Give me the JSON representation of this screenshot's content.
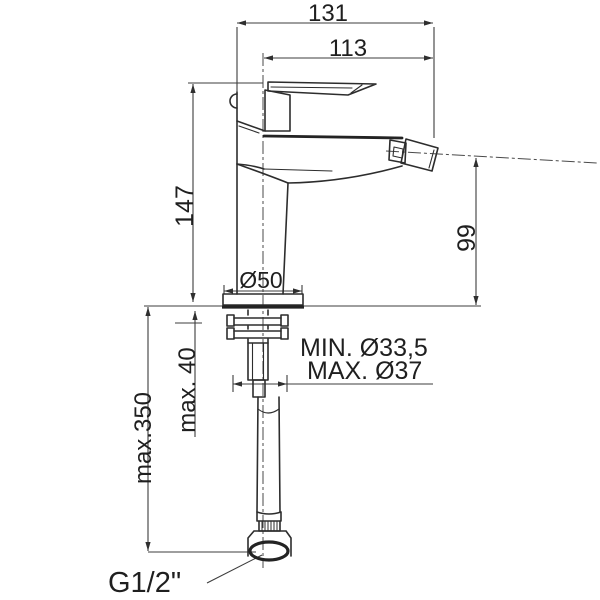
{
  "drawing": {
    "background": "#ffffff",
    "line_color": "#2d2d2d",
    "text_color": "#1f1f1f"
  },
  "labels": {
    "total_width": "131",
    "spout_reach": "113",
    "body_height": "147",
    "spout_height": "99",
    "base_diameter": "Ø50",
    "mount_hole_min": "MIN. Ø33,5",
    "mount_hole_max": "MAX. Ø37",
    "max_deck_thickness": "max. 40",
    "max_hose_reach": "max.350",
    "thread_size": "G1/2\""
  }
}
